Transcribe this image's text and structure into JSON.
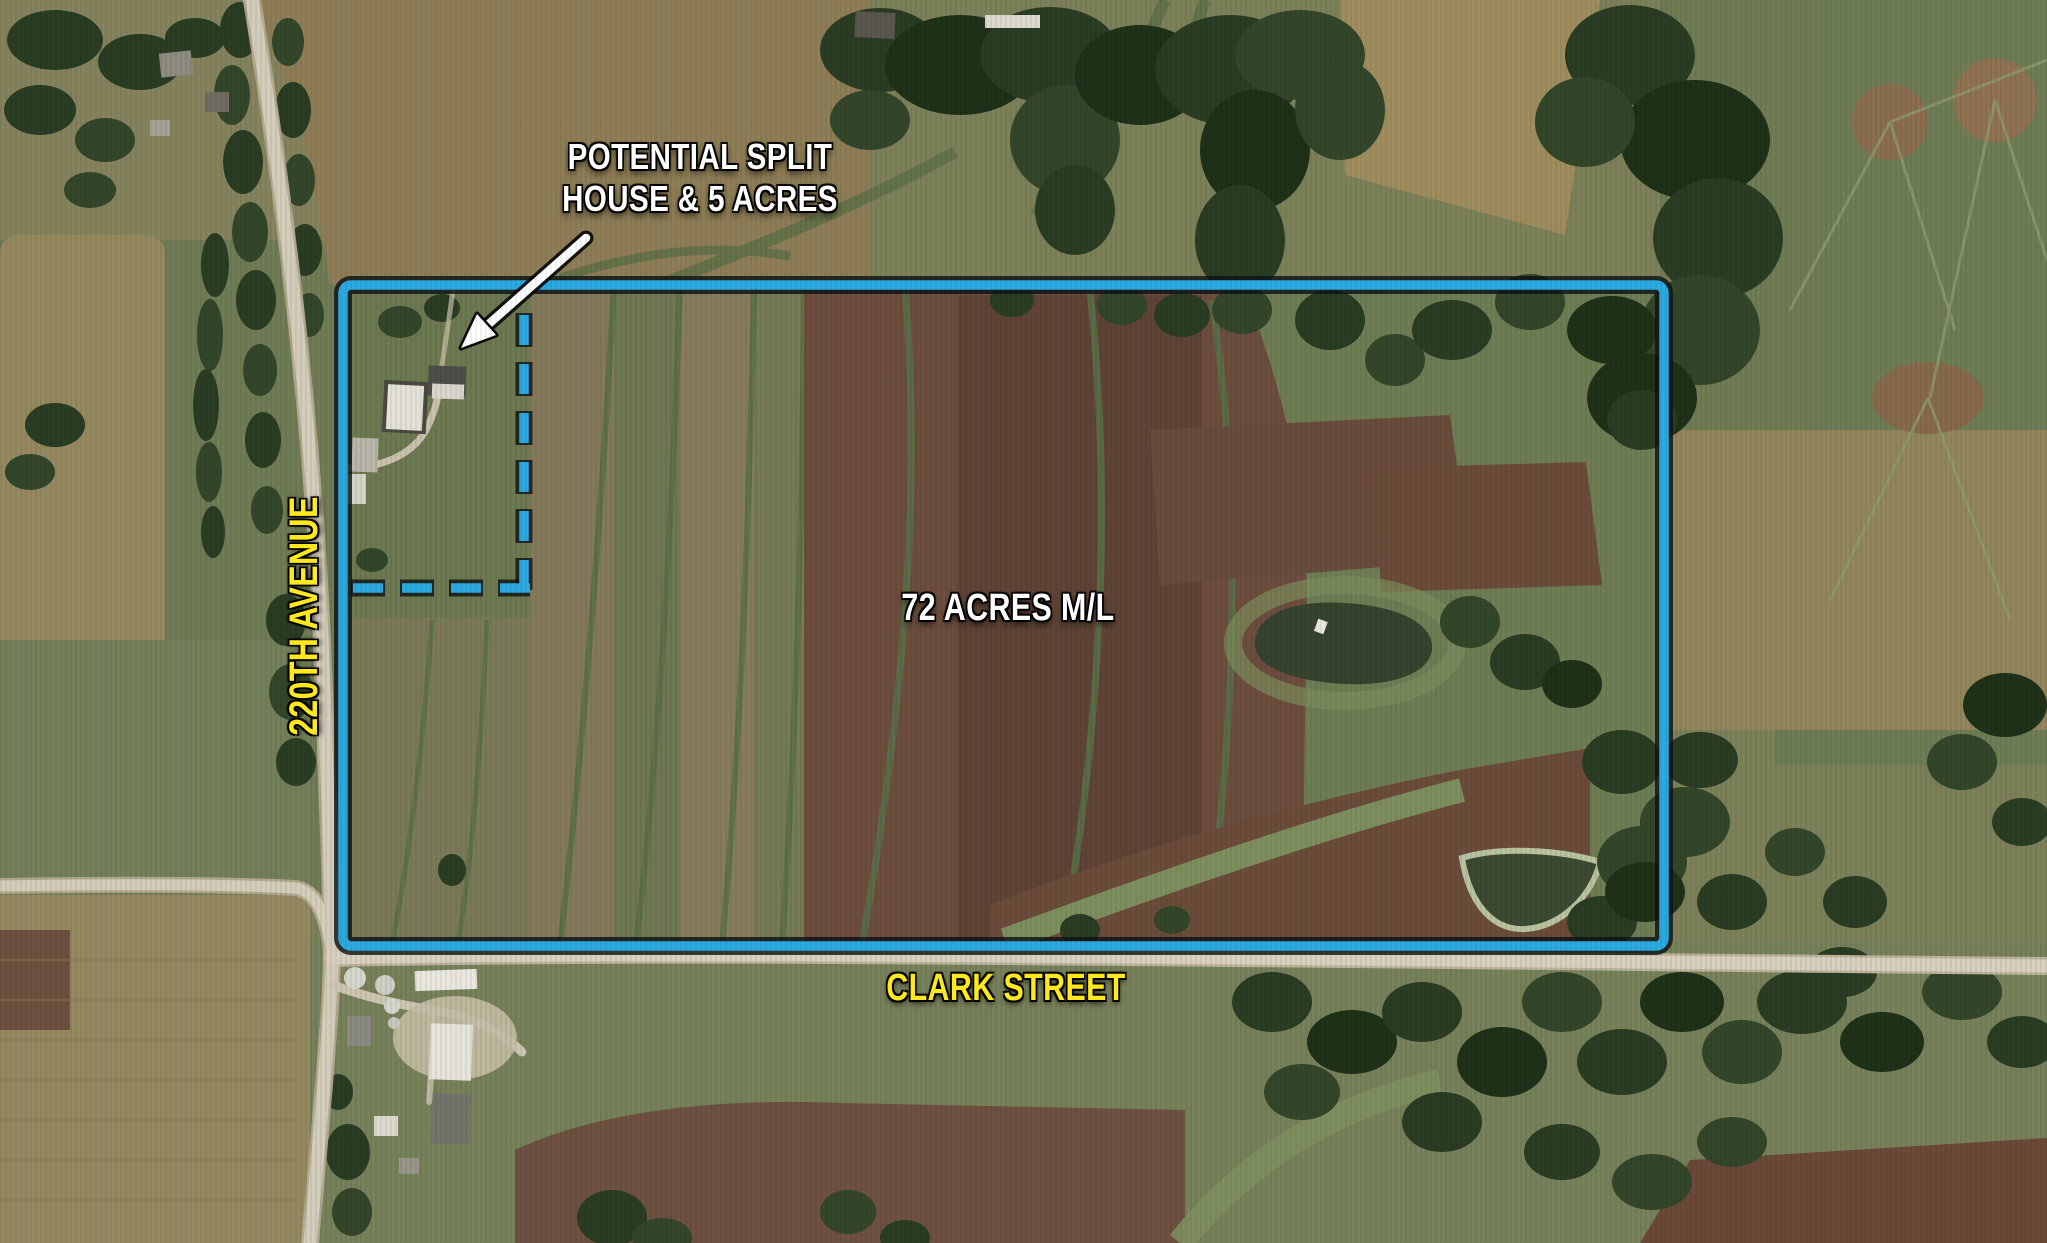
{
  "map_annotations": {
    "callout": {
      "line1": "POTENTIAL SPLIT",
      "line2": "HOUSE & 5 ACRES"
    },
    "area_label": "72 ACRES M/L",
    "road_labels": {
      "vertical": "220TH AVENUE",
      "horizontal": "CLARK STREET"
    }
  },
  "colors": {
    "boundary_blue": "#2BAAE2",
    "road_label_yellow": "#FFE81C",
    "callout_white": "#FFFFFF"
  },
  "icons": {
    "callout_arrow": "arrow pointing from callout text to house site"
  }
}
